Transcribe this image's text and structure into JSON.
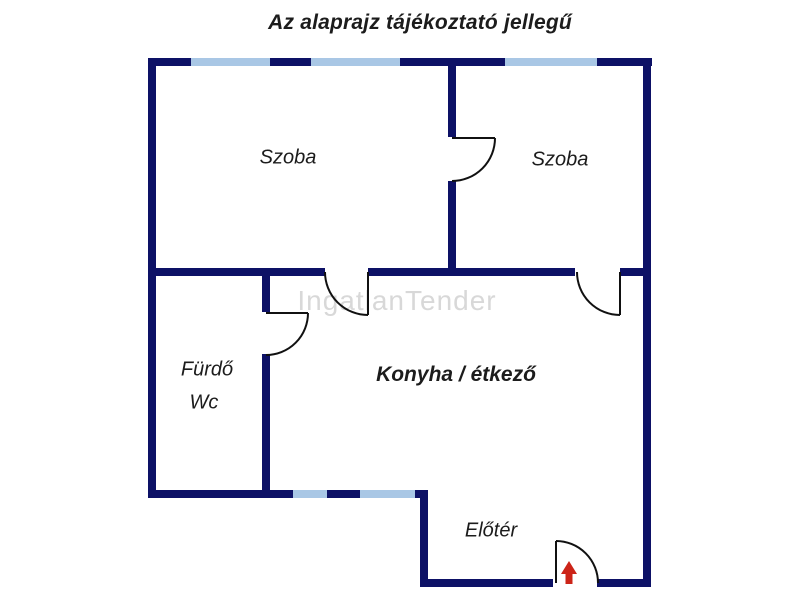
{
  "title": "Az alaprajz tájékoztató jellegű",
  "watermark": "IngatlanTender",
  "rooms": {
    "szoba_left": "Szoba",
    "szoba_right": "Szoba",
    "furdo": "Fürdő",
    "wc": "Wc",
    "konyha": "Konyha / étkező",
    "eloter": "Előtér"
  },
  "colors": {
    "wall": "#0d1166",
    "window": "#a9c7e5",
    "door": "#111111",
    "arrow": "#cc2418",
    "watermark": "#d8d8d8",
    "text": "#1c1c1c"
  }
}
